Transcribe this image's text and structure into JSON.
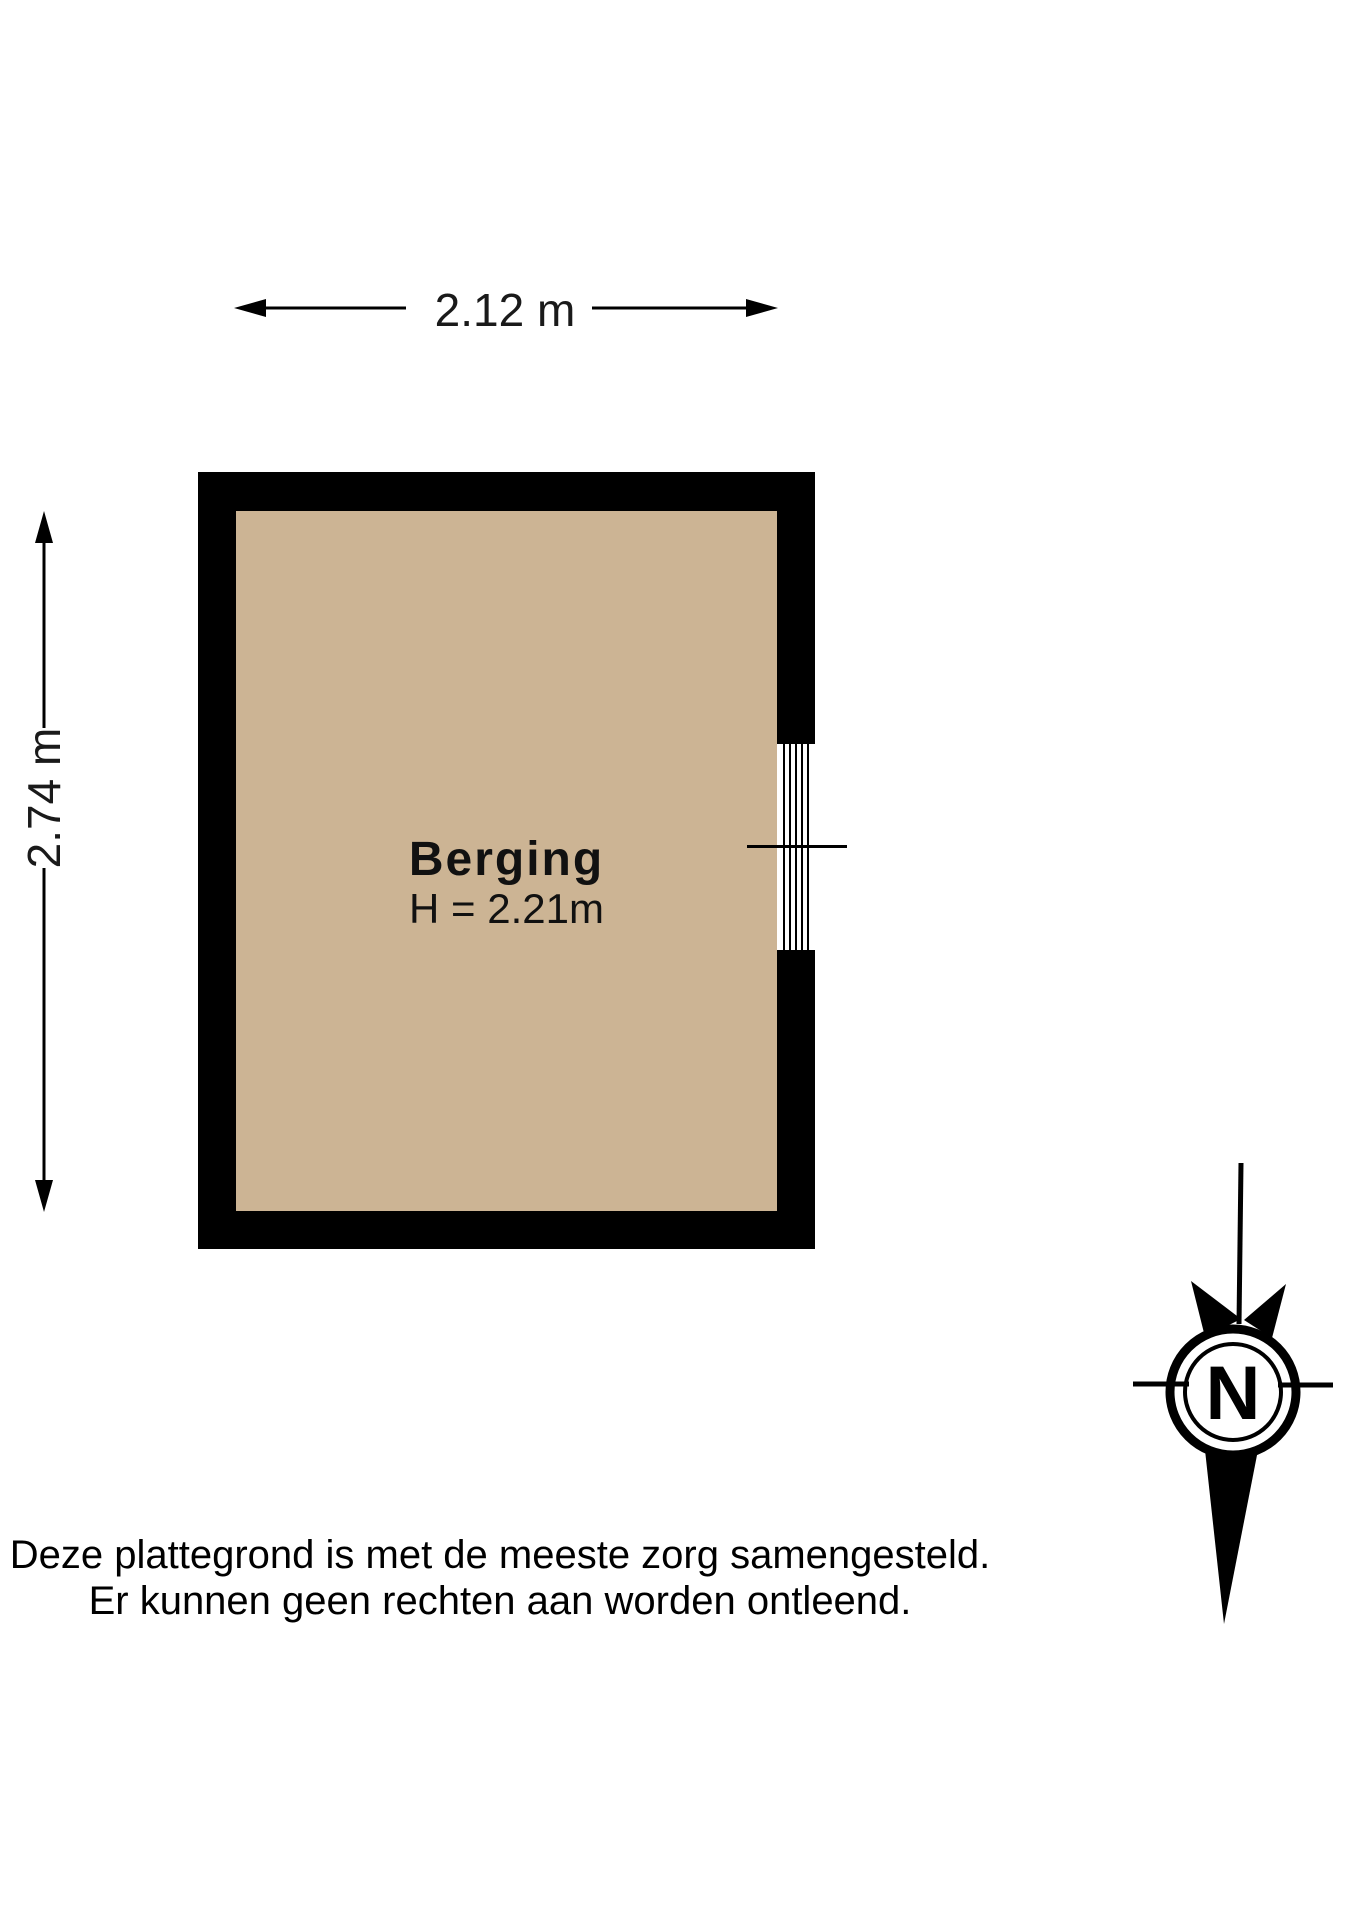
{
  "plan": {
    "room_label": "Berging",
    "room_height_label": "H = 2.21m",
    "width_dimension_label": "2.12 m",
    "height_dimension_label": "2.74 m"
  },
  "compass": {
    "north_label": "N"
  },
  "disclaimer": {
    "line1": "Deze plattegrond is met de meeste zorg samengesteld.",
    "line2": "Er kunnen geen rechten aan worden ontleend."
  },
  "colors": {
    "wall": "#000000",
    "floor": "#ccb494",
    "background": "#ffffff",
    "line": "#000000"
  }
}
